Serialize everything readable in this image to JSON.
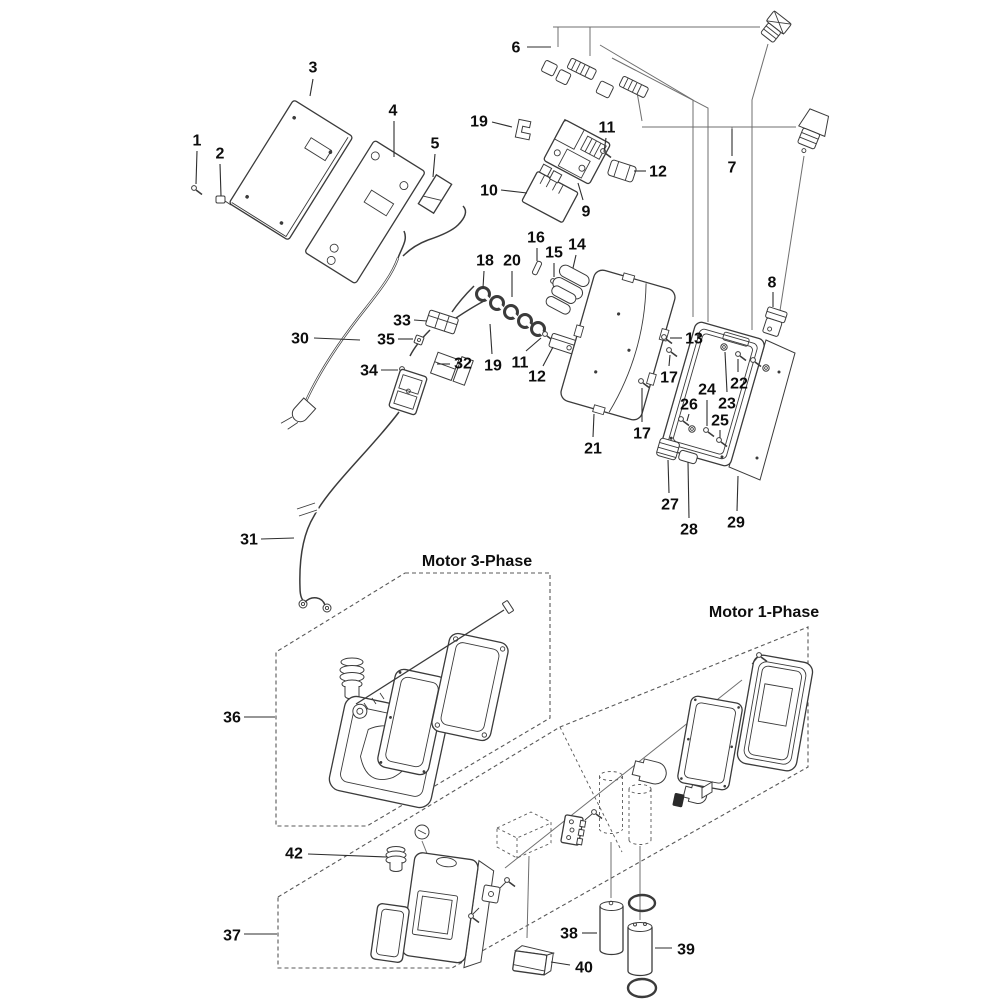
{
  "page": {
    "background": "#ffffff",
    "line_color": "#3b3b3b",
    "label_color": "#0d0d0d"
  },
  "diagram": {
    "type": "exploded-parts-diagram",
    "title_groups": [
      {
        "id": "motor-3-phase",
        "label": "Motor 3-Phase",
        "x": 477,
        "y": 566
      },
      {
        "id": "motor-1-phase",
        "label": "Motor 1-Phase",
        "x": 764,
        "y": 617
      }
    ],
    "callouts": [
      {
        "ref": "1",
        "label": "1",
        "x": 197,
        "y": 140,
        "leader": [
          197,
          151,
          196,
          184
        ]
      },
      {
        "ref": "2",
        "label": "2",
        "x": 220,
        "y": 153,
        "leader": [
          220,
          164,
          221,
          196
        ]
      },
      {
        "ref": "3",
        "label": "3",
        "x": 313,
        "y": 67,
        "leader": [
          313,
          79,
          310,
          96
        ]
      },
      {
        "ref": "4",
        "label": "4",
        "x": 393,
        "y": 110,
        "leader": [
          394,
          121,
          394,
          157
        ]
      },
      {
        "ref": "5",
        "label": "5",
        "x": 435,
        "y": 143,
        "leader": [
          435,
          154,
          433,
          177
        ]
      },
      {
        "ref": "6",
        "label": "6",
        "x": 516,
        "y": 47,
        "leader": [
          527,
          47,
          551,
          47
        ]
      },
      {
        "ref": "7",
        "label": "7",
        "x": 732,
        "y": 167,
        "leader": [
          732,
          156,
          732,
          129
        ]
      },
      {
        "ref": "8",
        "label": "8",
        "x": 772,
        "y": 282,
        "leader": [
          773,
          292,
          773,
          307
        ]
      },
      {
        "ref": "9",
        "label": "9",
        "x": 586,
        "y": 211,
        "leader": [
          583,
          200,
          578,
          183
        ]
      },
      {
        "ref": "10",
        "label": "10",
        "x": 489,
        "y": 190,
        "leader": [
          501,
          190,
          527,
          193
        ]
      },
      {
        "ref": "11-1",
        "label": "11",
        "x": 607,
        "y": 127,
        "leader": [
          606,
          138,
          604,
          152
        ]
      },
      {
        "ref": "12-1",
        "label": "12",
        "x": 658,
        "y": 171,
        "leader": [
          646,
          171,
          634,
          171
        ]
      },
      {
        "ref": "13",
        "label": "13",
        "x": 694,
        "y": 338,
        "leader": [
          682,
          338,
          670,
          338
        ]
      },
      {
        "ref": "14",
        "label": "14",
        "x": 577,
        "y": 244,
        "leader": [
          576,
          255,
          573,
          268
        ]
      },
      {
        "ref": "15",
        "label": "15",
        "x": 554,
        "y": 252,
        "leader": [
          554,
          263,
          554,
          277
        ]
      },
      {
        "ref": "16",
        "label": "16",
        "x": 536,
        "y": 237,
        "leader": [
          537,
          248,
          537,
          261
        ]
      },
      {
        "ref": "17-1",
        "label": "17",
        "x": 669,
        "y": 377,
        "leader": [
          669,
          366,
          670,
          355
        ]
      },
      {
        "ref": "17-2",
        "label": "17",
        "x": 642,
        "y": 433,
        "leader": [
          642,
          422,
          642,
          388
        ]
      },
      {
        "ref": "18",
        "label": "18",
        "x": 485,
        "y": 260,
        "leader": [
          484,
          271,
          483,
          288
        ]
      },
      {
        "ref": "19-1",
        "label": "19",
        "x": 479,
        "y": 121,
        "leader": [
          492,
          122,
          512,
          127
        ]
      },
      {
        "ref": "19-2",
        "label": "19",
        "x": 493,
        "y": 365,
        "leader": [
          492,
          354,
          490,
          324
        ]
      },
      {
        "ref": "20",
        "label": "20",
        "x": 512,
        "y": 260,
        "leader": [
          512,
          271,
          512,
          297
        ]
      },
      {
        "ref": "11-2",
        "label": "11",
        "x": 520,
        "y": 362,
        "leader": [
          526,
          351,
          541,
          338
        ]
      },
      {
        "ref": "12-2",
        "label": "12",
        "x": 537,
        "y": 376,
        "leader": [
          543,
          366,
          553,
          347
        ]
      },
      {
        "ref": "21",
        "label": "21",
        "x": 593,
        "y": 448,
        "leader": [
          593,
          437,
          594,
          414
        ]
      },
      {
        "ref": "22",
        "label": "22",
        "x": 739,
        "y": 383,
        "leader": [
          738,
          372,
          738,
          359
        ]
      },
      {
        "ref": "23",
        "label": "23",
        "x": 727,
        "y": 403,
        "leader": [
          727,
          392,
          725,
          352
        ]
      },
      {
        "ref": "24",
        "label": "24",
        "x": 707,
        "y": 389,
        "leader": [
          707,
          400,
          707,
          426
        ]
      },
      {
        "ref": "25",
        "label": "25",
        "x": 720,
        "y": 420,
        "leader": [
          720,
          430,
          720,
          438
        ]
      },
      {
        "ref": "26",
        "label": "26",
        "x": 689,
        "y": 404,
        "leader": [
          689,
          414,
          687,
          421
        ]
      },
      {
        "ref": "27",
        "label": "27",
        "x": 670,
        "y": 504,
        "leader": [
          669,
          493,
          668,
          460
        ]
      },
      {
        "ref": "28",
        "label": "28",
        "x": 689,
        "y": 529,
        "leader": [
          689,
          518,
          688,
          462
        ]
      },
      {
        "ref": "29",
        "label": "29",
        "x": 736,
        "y": 522,
        "leader": [
          737,
          511,
          738,
          476
        ]
      },
      {
        "ref": "30",
        "label": "30",
        "x": 300,
        "y": 338,
        "leader": [
          314,
          338,
          360,
          340
        ]
      },
      {
        "ref": "31",
        "label": "31",
        "x": 249,
        "y": 539,
        "leader": [
          261,
          539,
          294,
          538
        ]
      },
      {
        "ref": "32",
        "label": "32",
        "x": 463,
        "y": 363,
        "leader": [
          450,
          364,
          437,
          364
        ]
      },
      {
        "ref": "33",
        "label": "33",
        "x": 402,
        "y": 320,
        "leader": [
          414,
          320,
          427,
          321
        ]
      },
      {
        "ref": "34",
        "label": "34",
        "x": 369,
        "y": 370,
        "leader": [
          381,
          370,
          398,
          370
        ]
      },
      {
        "ref": "35",
        "label": "35",
        "x": 386,
        "y": 339,
        "leader": [
          398,
          339,
          413,
          339
        ]
      },
      {
        "ref": "36",
        "label": "36",
        "x": 232,
        "y": 717,
        "leader": [
          244,
          717,
          275,
          717
        ]
      },
      {
        "ref": "37",
        "label": "37",
        "x": 232,
        "y": 935,
        "leader": [
          244,
          934,
          277,
          934
        ]
      },
      {
        "ref": "38",
        "label": "38",
        "x": 569,
        "y": 933,
        "leader": [
          582,
          933,
          597,
          933
        ]
      },
      {
        "ref": "39",
        "label": "39",
        "x": 686,
        "y": 949,
        "leader": [
          672,
          948,
          655,
          948
        ]
      },
      {
        "ref": "40",
        "label": "40",
        "x": 584,
        "y": 967,
        "leader": [
          570,
          965,
          551,
          962
        ]
      },
      {
        "ref": "42",
        "label": "42",
        "x": 294,
        "y": 853,
        "leader": [
          308,
          854,
          387,
          857
        ]
      }
    ]
  }
}
